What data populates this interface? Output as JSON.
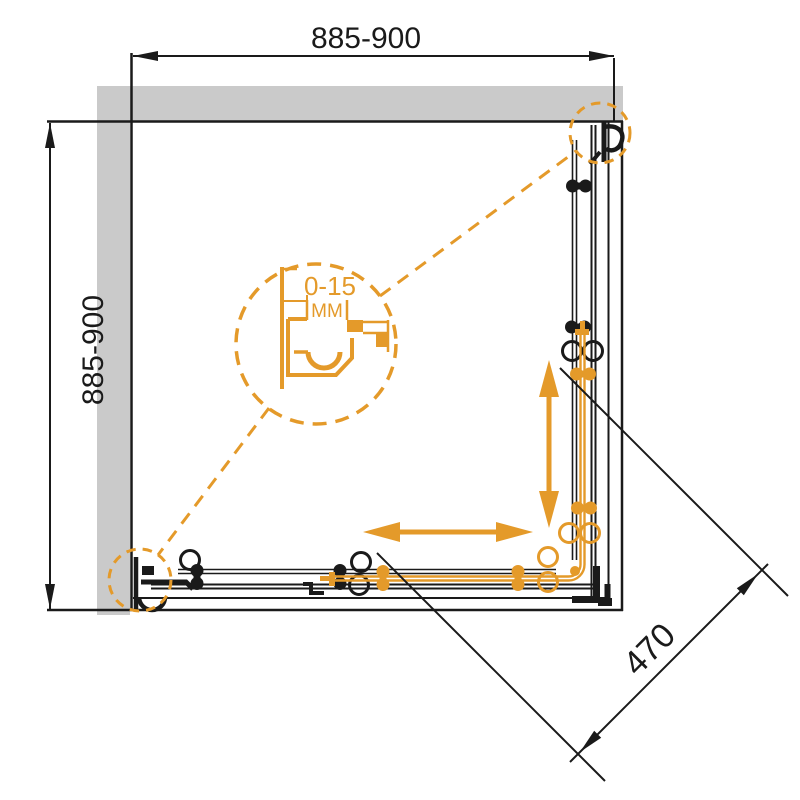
{
  "dimensions": {
    "top": "885-900",
    "left": "885-900",
    "diagonal": "470",
    "detail_gap": "0-15",
    "detail_unit": "MM"
  },
  "colors": {
    "accent_orange": "#e49a2a",
    "wall_gray": "#cacaca",
    "line_black": "#1a1a1a",
    "background": "#ffffff"
  }
}
